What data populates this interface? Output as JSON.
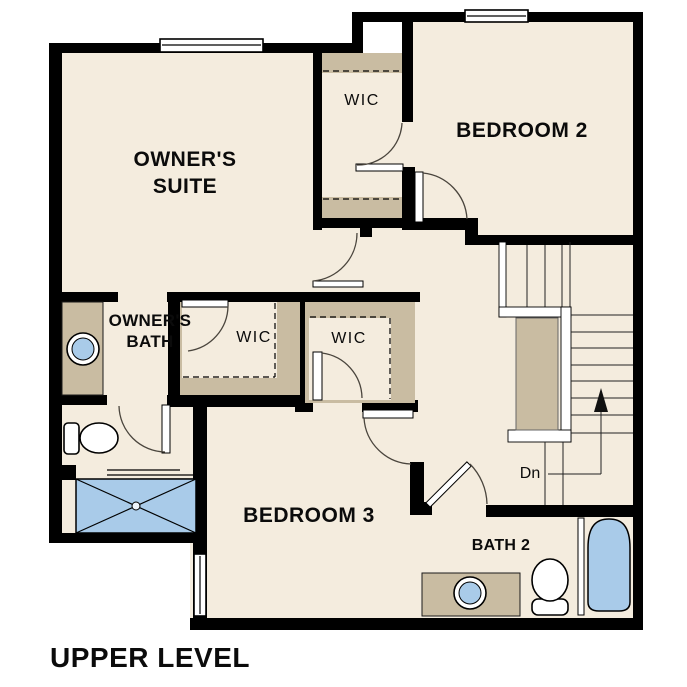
{
  "plan": {
    "level_title": "UPPER LEVEL",
    "rooms": {
      "owners_suite_line1": "OWNER'S",
      "owners_suite_line2": "SUITE",
      "bedroom2": "BEDROOM 2",
      "bedroom3": "BEDROOM 3",
      "owners_bath_line1": "OWNER'S",
      "owners_bath_line2": "BATH",
      "wic_top": "WIC",
      "wic_middle": "WIC",
      "wic_right": "WIC",
      "bath2": "BATH 2",
      "stairs_down": "Dn"
    },
    "colors": {
      "floor": "#f4ecde",
      "casework": "#c9bca2",
      "fixture_blue": "#a9cbe9",
      "wall": "#000000",
      "background": "#ffffff"
    }
  }
}
